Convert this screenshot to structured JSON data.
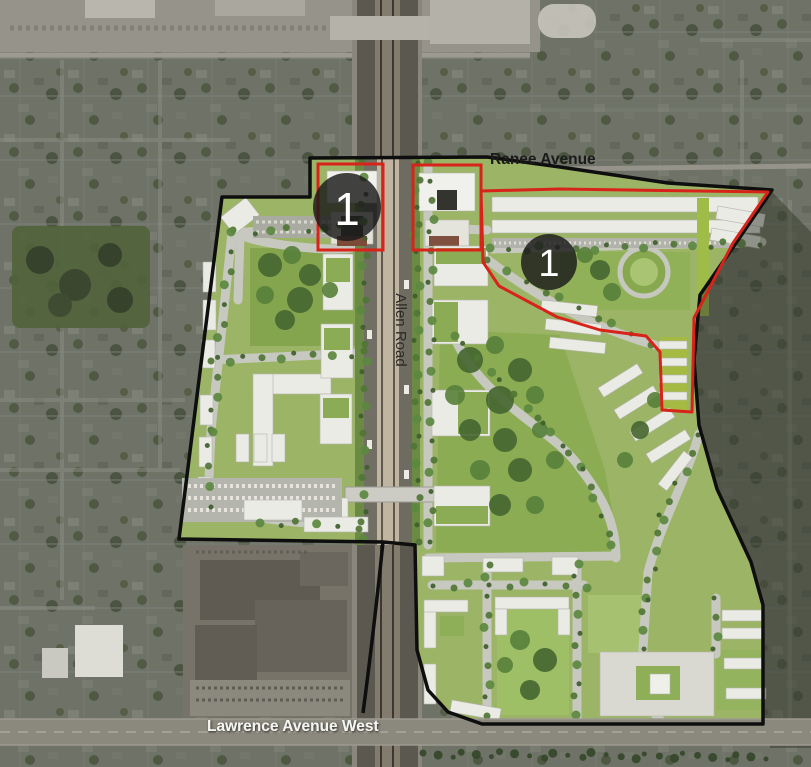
{
  "map": {
    "title": "Aerial master plan map",
    "streets": {
      "ranee_avenue": "Ranee Avenue",
      "allen_road": "Allen Road",
      "lawrence_avenue_west": "Lawrence Avenue West"
    },
    "markers": [
      {
        "id": "phase-marker-west",
        "label": "1"
      },
      {
        "id": "phase-marker-east",
        "label": "1"
      }
    ],
    "colors": {
      "site_boundary": "#0e0e0e",
      "phase1_boundary": "#d8231a",
      "marker_fill": "#1a1a1a",
      "marker_label": "#ffffff",
      "plan_green": "#9cb465",
      "aerial_base": "#6e7267"
    }
  }
}
